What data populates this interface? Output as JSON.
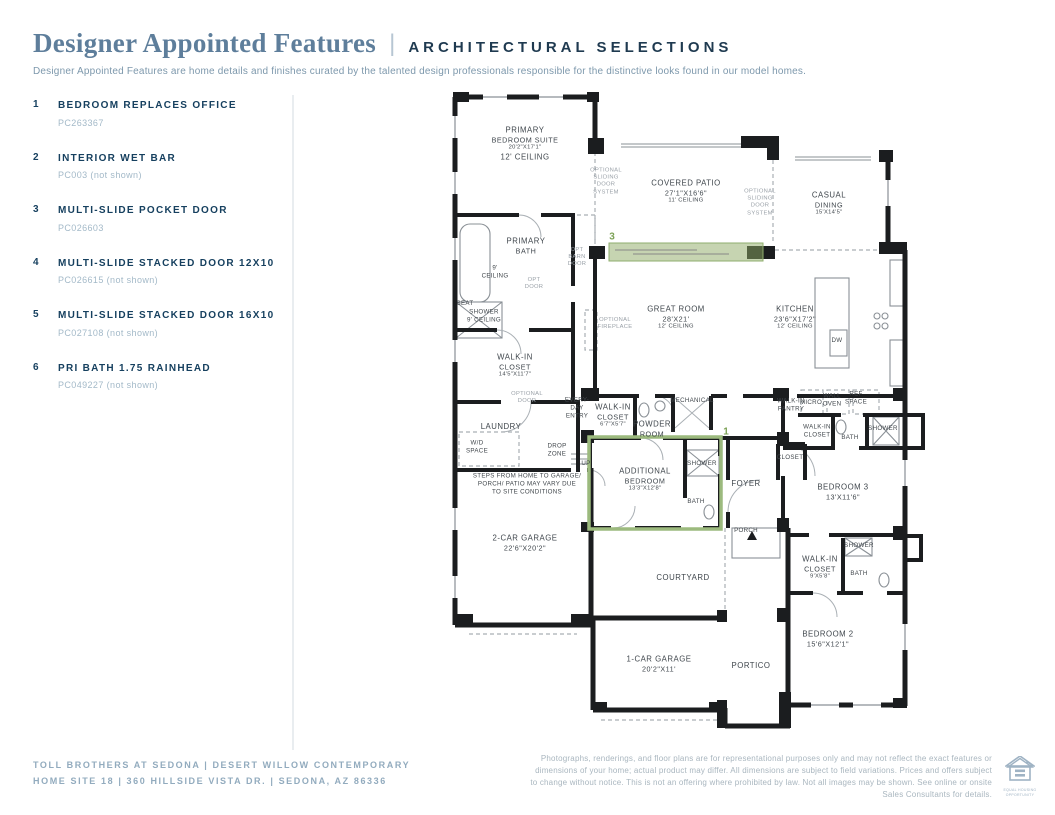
{
  "header": {
    "title": "Designer Appointed Features",
    "separator": "|",
    "subtitle": "ARCHITECTURAL SELECTIONS",
    "description": "Designer Appointed Features are home details and finishes curated by the talented design professionals responsible for the distinctive looks found in our model homes."
  },
  "features": [
    {
      "num": "1",
      "name": "BEDROOM REPLACES OFFICE",
      "code": "PC263367"
    },
    {
      "num": "2",
      "name": "INTERIOR WET BAR",
      "code": "PC003 (not shown)"
    },
    {
      "num": "3",
      "name": "MULTI-SLIDE POCKET DOOR",
      "code": "PC026603"
    },
    {
      "num": "4",
      "name": "MULTI-SLIDE STACKED DOOR 12X10",
      "code": "PC026615 (not shown)"
    },
    {
      "num": "5",
      "name": "MULTI-SLIDE STACKED DOOR 16X10",
      "code": "PC027108 (not shown)"
    },
    {
      "num": "6",
      "name": "PRI BATH 1.75 RAINHEAD",
      "code": "PC049227 (not shown)"
    }
  ],
  "footer": {
    "left_line1": "TOLL BROTHERS AT SEDONA   |   DESERT WILLOW CONTEMPORARY",
    "left_line2": "HOME SITE 18   |   360 HILLSIDE VISTA DR.   |   SEDONA, AZ 86336",
    "disclaimer": "Photographs, renderings, and floor plans are for representational purposes only and may not reflect the exact features or dimensions of your home; actual product may differ. All dimensions are subject to field variations. Prices and offers subject to change without notice. This is not an offering where prohibited by law. Not all images may be shown. See online or onsite Sales Consultants for details.",
    "equal_housing_label": "EQUAL HOUSING OPPORTUNITY"
  },
  "colors": {
    "title_blue": "#5e7e9b",
    "navy": "#16405f",
    "light_code_blue": "#a3b9c8",
    "footer_blue": "#92abbe",
    "highlight_green": "#9cba7e",
    "marker_green": "#7da257",
    "wall_black": "#1b1d1f"
  },
  "floorplan": {
    "markers": [
      {
        "name": "marker-3",
        "cls": "marker",
        "x": 169,
        "y": 149,
        "lines": [
          "3"
        ]
      },
      {
        "name": "marker-1",
        "cls": "marker",
        "x": 283,
        "y": 344,
        "lines": [
          "1"
        ]
      }
    ],
    "labels": [
      {
        "cls": "room",
        "x": 82,
        "y": 56,
        "lines": [
          "PRIMARY",
          "BEDROOM SUITE",
          "20'2\"X17'1\""
        ],
        "extra": "12' CEILING"
      },
      {
        "cls": "room",
        "x": 243,
        "y": 104,
        "lines": [
          "COVERED PATIO",
          "27'1\"X16'6\""
        ],
        "extra": "11' CEILING"
      },
      {
        "cls": "room",
        "x": 386,
        "y": 116,
        "lines": [
          "CASUAL",
          "DINING",
          "15'X14'5\""
        ]
      },
      {
        "cls": "room",
        "x": 83,
        "y": 158,
        "lines": [
          "PRIMARY",
          "BATH"
        ]
      },
      {
        "cls": "room",
        "x": 233,
        "y": 230,
        "lines": [
          "GREAT ROOM",
          "28'X21'"
        ],
        "extra": "12' CEILING"
      },
      {
        "cls": "room",
        "x": 352,
        "y": 230,
        "lines": [
          "KITCHEN",
          "23'6\"X17'2\""
        ],
        "extra": "12' CEILING"
      },
      {
        "cls": "room",
        "x": 72,
        "y": 278,
        "lines": [
          "WALK-IN",
          "CLOSET",
          "14'5\"X11'7\""
        ]
      },
      {
        "cls": "room",
        "x": 58,
        "y": 339,
        "lines": [
          "LAUNDRY"
        ]
      },
      {
        "cls": "room",
        "x": 170,
        "y": 328,
        "lines": [
          "WALK-IN",
          "CLOSET",
          "6'7\"X5'7\""
        ]
      },
      {
        "cls": "room",
        "x": 209,
        "y": 341,
        "lines": [
          "POWDER",
          "ROOM"
        ]
      },
      {
        "cls": "room",
        "x": 202,
        "y": 392,
        "lines": [
          "ADDITIONAL",
          "BEDROOM",
          "13'3\"X12'8\""
        ]
      },
      {
        "cls": "room",
        "x": 303,
        "y": 396,
        "lines": [
          "FOYER"
        ]
      },
      {
        "cls": "room",
        "x": 400,
        "y": 404,
        "lines": [
          "BEDROOM 3",
          "13'X11'6\""
        ]
      },
      {
        "cls": "room",
        "x": 82,
        "y": 455,
        "lines": [
          "2-CAR GARAGE",
          "22'6\"X20'2\""
        ]
      },
      {
        "cls": "room",
        "x": 240,
        "y": 490,
        "lines": [
          "COURTYARD"
        ]
      },
      {
        "cls": "room",
        "x": 216,
        "y": 576,
        "lines": [
          "1-CAR GARAGE",
          "20'2\"X11'"
        ]
      },
      {
        "cls": "room",
        "x": 308,
        "y": 578,
        "lines": [
          "PORTICO"
        ]
      },
      {
        "cls": "room",
        "x": 385,
        "y": 551,
        "lines": [
          "BEDROOM 2",
          "15'6\"X12'1\""
        ]
      },
      {
        "cls": "room",
        "x": 377,
        "y": 480,
        "lines": [
          "WALK-IN",
          "CLOSET",
          "9'X5'8\""
        ]
      },
      {
        "cls": "small",
        "x": 22,
        "y": 216,
        "lines": [
          "SEAT"
        ]
      },
      {
        "cls": "small",
        "x": 41,
        "y": 228,
        "lines": [
          "SHOWER",
          "9' CEILING"
        ]
      },
      {
        "cls": "small",
        "x": 52,
        "y": 184,
        "lines": [
          "9'",
          "CEILING"
        ]
      },
      {
        "cls": "small",
        "x": 134,
        "y": 320,
        "lines": [
          "EVERY-",
          "DAY",
          "ENTRY"
        ]
      },
      {
        "cls": "small",
        "x": 114,
        "y": 362,
        "lines": [
          "DROP",
          "ZONE"
        ]
      },
      {
        "cls": "small",
        "x": 143,
        "y": 376,
        "lines": [
          "UP"
        ]
      },
      {
        "cls": "small",
        "x": 34,
        "y": 359,
        "lines": [
          "W/D",
          "SPACE"
        ]
      },
      {
        "cls": "small",
        "x": 249,
        "y": 313,
        "lines": [
          "MECHANICAL"
        ]
      },
      {
        "cls": "small",
        "x": 348,
        "y": 317,
        "lines": [
          "WALK-IN",
          "PANTRY"
        ]
      },
      {
        "cls": "small",
        "x": 368,
        "y": 315,
        "lines": [
          "MICRO"
        ]
      },
      {
        "cls": "small",
        "x": 389,
        "y": 312,
        "lines": [
          "WALL",
          "OVEN"
        ]
      },
      {
        "cls": "small",
        "x": 413,
        "y": 310,
        "lines": [
          "REF",
          "SPACE"
        ]
      },
      {
        "cls": "small",
        "x": 394,
        "y": 253,
        "lines": [
          "DW"
        ]
      },
      {
        "cls": "small",
        "x": 347,
        "y": 370,
        "lines": [
          "CLOSET"
        ]
      },
      {
        "cls": "small",
        "x": 374,
        "y": 343,
        "lines": [
          "WALK-IN",
          "CLOSET"
        ]
      },
      {
        "cls": "small",
        "x": 407,
        "y": 350,
        "lines": [
          "BATH"
        ]
      },
      {
        "cls": "small",
        "x": 440,
        "y": 341,
        "lines": [
          "SHOWER"
        ]
      },
      {
        "cls": "small",
        "x": 259,
        "y": 376,
        "lines": [
          "SHOWER"
        ]
      },
      {
        "cls": "small",
        "x": 253,
        "y": 414,
        "lines": [
          "BATH"
        ]
      },
      {
        "cls": "small",
        "x": 303,
        "y": 443,
        "lines": [
          "PORCH"
        ]
      },
      {
        "cls": "small",
        "x": 416,
        "y": 458,
        "lines": [
          "SHOWER"
        ]
      },
      {
        "cls": "small",
        "x": 416,
        "y": 486,
        "lines": [
          "BATH"
        ]
      },
      {
        "cls": "small",
        "x": 84,
        "y": 396,
        "lines": [
          "STEPS FROM HOME TO GARAGE/",
          "PORCH/ PATIO MAY VARY DUE",
          "TO SITE CONDITIONS"
        ]
      },
      {
        "cls": "opt",
        "x": 163,
        "y": 94,
        "lines": [
          "OPTIONAL",
          "SLIDING",
          "DOOR",
          "SYSTEM"
        ]
      },
      {
        "cls": "opt",
        "x": 317,
        "y": 115,
        "lines": [
          "OPTIONAL",
          "SLIDING",
          "DOOR",
          "SYSTEM"
        ]
      },
      {
        "cls": "opt",
        "x": 134,
        "y": 170,
        "lines": [
          "OPT",
          "BARN",
          "DOOR"
        ]
      },
      {
        "cls": "opt",
        "x": 91,
        "y": 196,
        "lines": [
          "OPT",
          "DOOR"
        ]
      },
      {
        "cls": "opt",
        "x": 172,
        "y": 236,
        "lines": [
          "OPTIONAL",
          "FIREPLACE"
        ]
      },
      {
        "cls": "opt",
        "x": 84,
        "y": 310,
        "lines": [
          "OPTIONAL",
          "DOOR"
        ]
      }
    ]
  }
}
